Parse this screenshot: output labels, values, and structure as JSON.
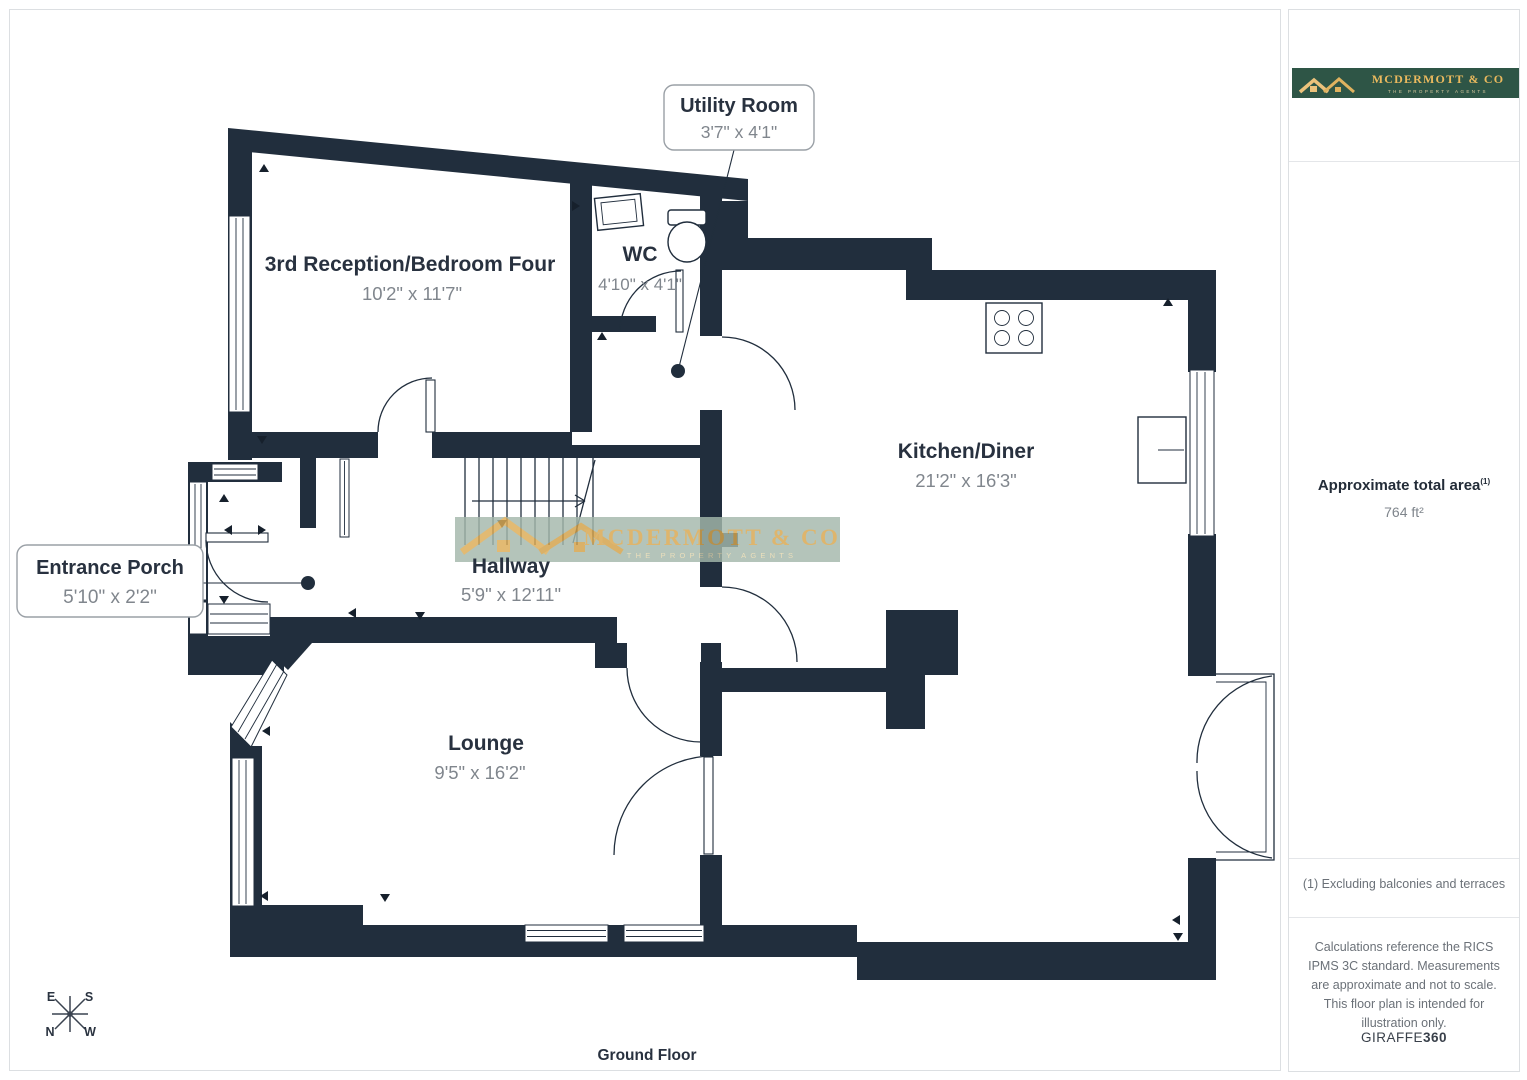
{
  "floorplan": {
    "title": "Ground Floor",
    "rooms": [
      {
        "name": "3rd Reception/Bedroom Four",
        "dims": "10'2\" x 11'7\""
      },
      {
        "name": "WC",
        "dims": "4'10\" x 4'1\""
      },
      {
        "name": "Kitchen/Diner",
        "dims": "21'2\" x 16'3\""
      },
      {
        "name": "Hallway",
        "dims": "5'9\" x 12'11\""
      },
      {
        "name": "Lounge",
        "dims": "9'5\" x 16'2\""
      }
    ],
    "callouts": [
      {
        "name": "Utility Room",
        "dims": "3'7\" x 4'1\""
      },
      {
        "name": "Entrance Porch",
        "dims": "5'10\" x 2'2\""
      }
    ],
    "compass": {
      "n": "N",
      "e": "E",
      "s": "S",
      "w": "W"
    }
  },
  "watermark": {
    "name": "MCDERMOTT & CO",
    "tagline": "THE PROPERTY AGENTS"
  },
  "sidebar": {
    "logo": {
      "name": "MCDERMOTT & CO",
      "tagline": "THE PROPERTY AGENTS"
    },
    "area_label": "Approximate total area",
    "area_sup": "(1)",
    "area_value": "764 ft²",
    "footnote": "(1) Excluding balconies and terraces",
    "disclaimer": "Calculations reference the RICS IPMS 3C standard. Measurements are approximate and not to scale. This floor plan is intended for illustration only.",
    "brand": "GIRAFFE",
    "brand_bold": "360"
  },
  "colors": {
    "wall": "#212e3d",
    "text_dark": "#28313f",
    "text_gray": "#80868d",
    "gold": "#d7a64e",
    "brand_green": "#2e5546",
    "band_green": "#a4b8ab",
    "frame_gray": "#dcdfe2"
  }
}
